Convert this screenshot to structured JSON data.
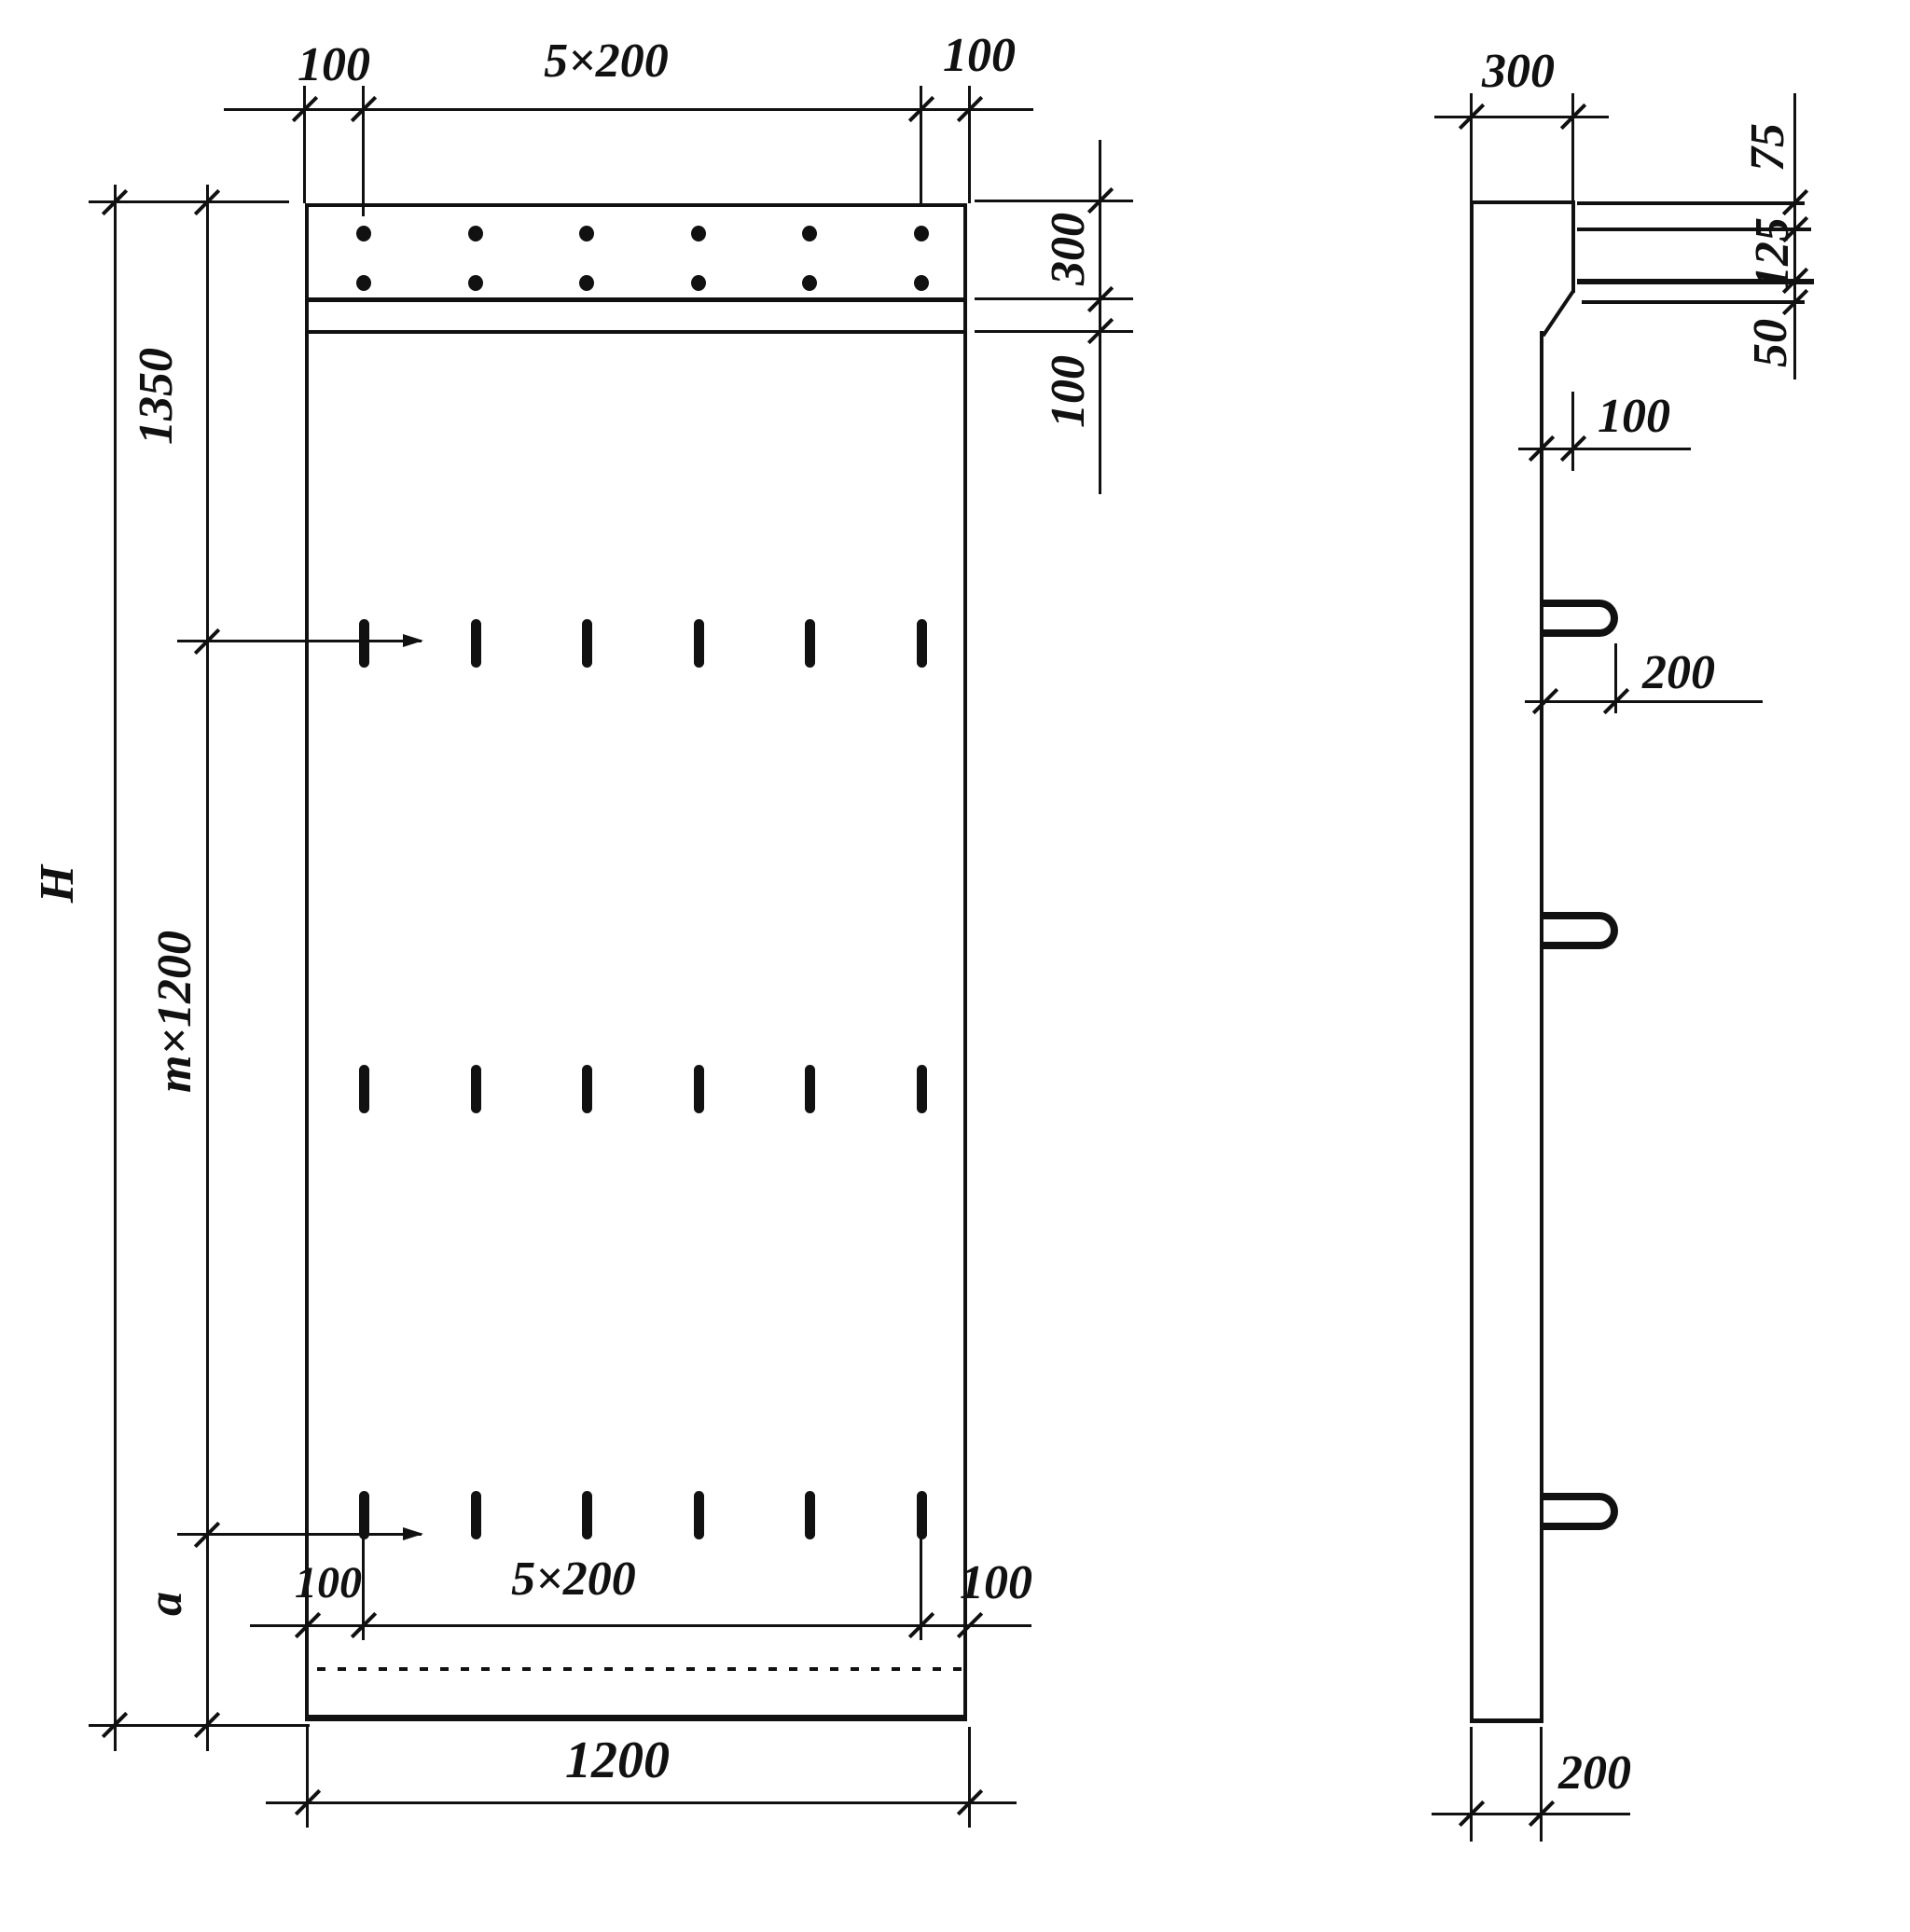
{
  "title": "Panel dimension drawing",
  "front_view": {
    "top_dim": {
      "left": "100",
      "middle": "5×200",
      "right": "100"
    },
    "right_dim": {
      "band_height": "300",
      "strip_height": "100"
    },
    "left_dim": {
      "top_section": "1350",
      "total_height": "H",
      "middle_section": "m×1200",
      "bottom_section": "a"
    },
    "bottom_inner_dim": {
      "left": "100",
      "middle": "5×200",
      "right": "100"
    },
    "bottom_dim": {
      "width": "1200"
    }
  },
  "side_view": {
    "top_dim": {
      "thickness": "300"
    },
    "right_dim": {
      "top_offset": "75",
      "middle_offset": "125",
      "bottom_offset": "50"
    },
    "step_dim": {
      "depth": "100"
    },
    "loop_dim": {
      "protrusion": "200"
    },
    "bottom_dim": {
      "thickness": "200"
    }
  },
  "colors": {
    "ink": "#111111",
    "paper": "#ffffff"
  }
}
